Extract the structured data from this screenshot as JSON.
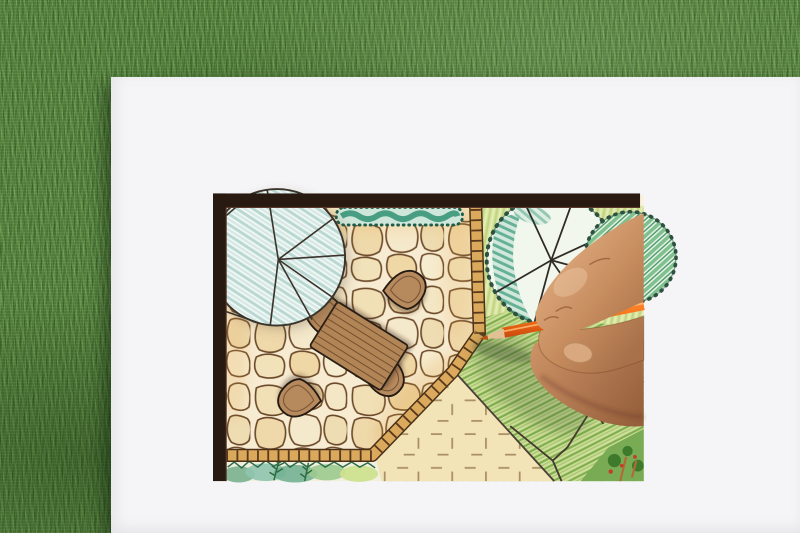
{
  "scene": {
    "description": "A hand drawing a garden landscape design plan with an orange colored pencil on a white sheet lying on green grass",
    "setting": "top-down photo, drawing board on lawn"
  },
  "background": {
    "surface": "grass lawn",
    "base_color": "#517c3b"
  },
  "paper": {
    "color": "#f5f5f7"
  },
  "plan": {
    "frame_color": "#281911",
    "inner_paper_color": "#f8f1de",
    "patio": {
      "paving": "flagstone",
      "stone_color": "#f0ddb2",
      "joint_color": "#6b4828"
    },
    "edging": {
      "material": "brick soldier course",
      "fill_color": "#dba95c",
      "joint_color": "#5a3a1e",
      "outline_color": "#4a3018"
    },
    "hedge": {
      "fill_color": "#cfe6da",
      "scribble_color": "#2f9173",
      "outline_color": "#1d5c49"
    },
    "patio_tree": {
      "style": "faceted circular canopy with teal pencil hatching",
      "hatch_color": "#b9d8d2",
      "outline_color": "#3a342c"
    },
    "bed_tree": {
      "style": "scalloped circular canopy with radial spokes",
      "outline_color": "#2e5240",
      "shade_color": "#55a98c"
    },
    "bed_shrub": {
      "style": "scalloped shrub with diagonal stripes",
      "stripe_color": "#7fc08f"
    },
    "table": {
      "shape": "rectangular plank table",
      "fill_color": "#b28557",
      "plank_color": "#75512f",
      "outline_color": "#2a1f15"
    },
    "chairs": {
      "count": 4,
      "fill_color": "#b78a5e",
      "outline_color": "#241a12"
    },
    "lawn_panel": {
      "symbol": "cross-dash turf marks",
      "fill_color": "#f3e4b8",
      "mark_color": "#a98f62"
    },
    "grass_hatch": {
      "fill_color": "#cfdf9a",
      "stroke_color": "#7fae4e"
    },
    "planting_strip": {
      "wash_colors": [
        "#74b193",
        "#8fc4ae",
        "#cde08f"
      ],
      "fern_color": "#2d6b3e"
    },
    "rock_path_outline": "#453a2e",
    "corner_planting": {
      "leaf_color": "#3e7a2b",
      "berry_color": "#c23c2a",
      "stem_color": "#b06a35"
    }
  },
  "hand": {
    "skin_tone": "#c08a5e",
    "pose": "gripping pencil, entering from right edge"
  },
  "pencil": {
    "body_color": "#f97316",
    "wood_color": "#e2c094",
    "lead_color": "#b4540f",
    "type": "colored pencil"
  }
}
